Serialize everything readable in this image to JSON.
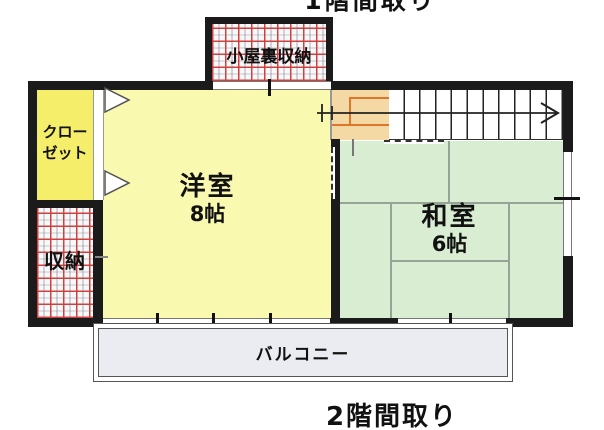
{
  "caption_top_partial": "1階間取り",
  "caption_bottom": "2階間取り",
  "rooms": {
    "attic": {
      "label": "小屋裏収納"
    },
    "closet": {
      "line1": "クロー",
      "line2": "ゼット"
    },
    "western": {
      "name": "洋室",
      "size": "8帖"
    },
    "japanese": {
      "name": "和室",
      "size": "6帖"
    },
    "storage": {
      "label": "収納"
    },
    "balcony": {
      "label": "バルコニー"
    }
  },
  "stairs": {
    "direction": "up-right-arrow"
  },
  "colors": {
    "wall": "#1b1b1b",
    "western_room_fill": "#faf9b0",
    "closet_fill": "#f5ee6a",
    "japanese_room_fill": "#d9edd2",
    "stair_landing_fill": "#f5d9a4",
    "stair_landing_line": "#e0762c",
    "storage_grid_line": "#cf3b3b",
    "balcony_fill": "#eaecf1"
  }
}
